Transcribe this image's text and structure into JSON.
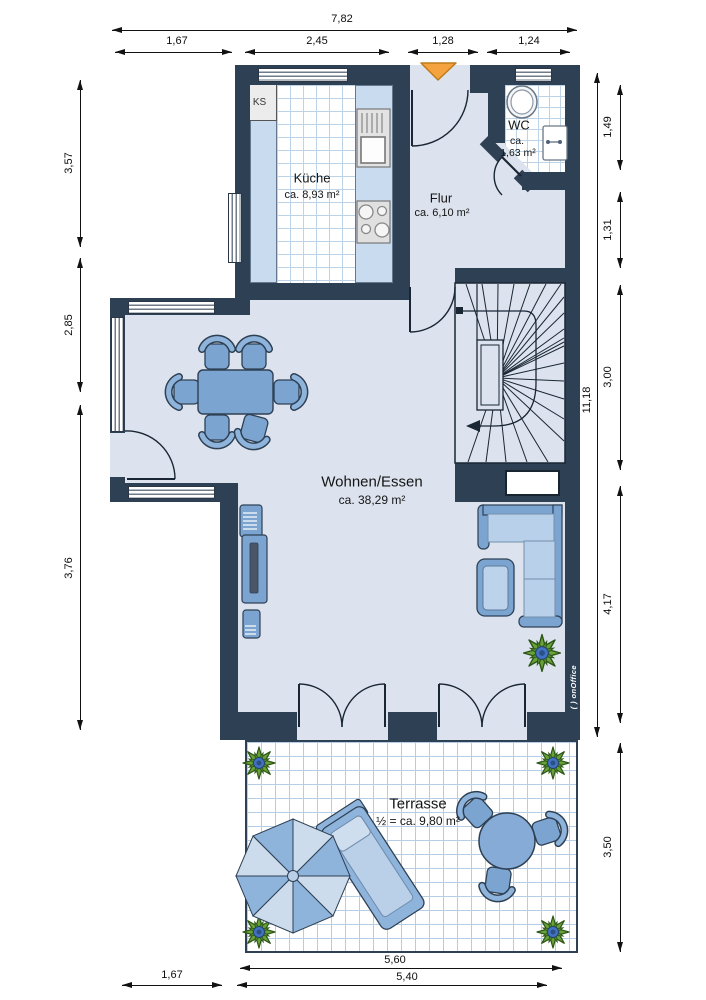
{
  "plan": {
    "rooms": {
      "kueche": {
        "name": "Küche",
        "area": "ca. 8,93 m²"
      },
      "flur": {
        "name": "Flur",
        "area": "ca. 6,10 m²"
      },
      "wc": {
        "name": "WC",
        "area_prefix": "ca.",
        "area_value": "1,63 m²"
      },
      "wohnen_essen": {
        "name": "Wohnen/Essen",
        "area": "ca. 38,29 m²"
      },
      "terrasse": {
        "name": "Terrasse",
        "area": "½ = ca. 9,80 m²"
      }
    },
    "labels": {
      "fridge": "KS"
    },
    "watermark": "( ) onOffice"
  },
  "dims": {
    "top_total": "7,82",
    "top": [
      "1,67",
      "2,45",
      "1,28",
      "1,24"
    ],
    "left": [
      "3,57",
      "2,85",
      "3,76"
    ],
    "right_total": "11,18",
    "right": [
      "1,49",
      "1,31",
      "3,00",
      "4,17",
      "3,50"
    ],
    "bottom": [
      "5,60",
      "5,40",
      "1,67"
    ]
  },
  "colors": {
    "wall": "#2e4054",
    "room": "#dce3ee",
    "tile_line": "#bcd3e8",
    "furniture": "#7ba4d1",
    "furniture_light": "#b9d0ea",
    "plant_green": "#6aa23a",
    "entrance_arrow": "#f4a33f"
  }
}
